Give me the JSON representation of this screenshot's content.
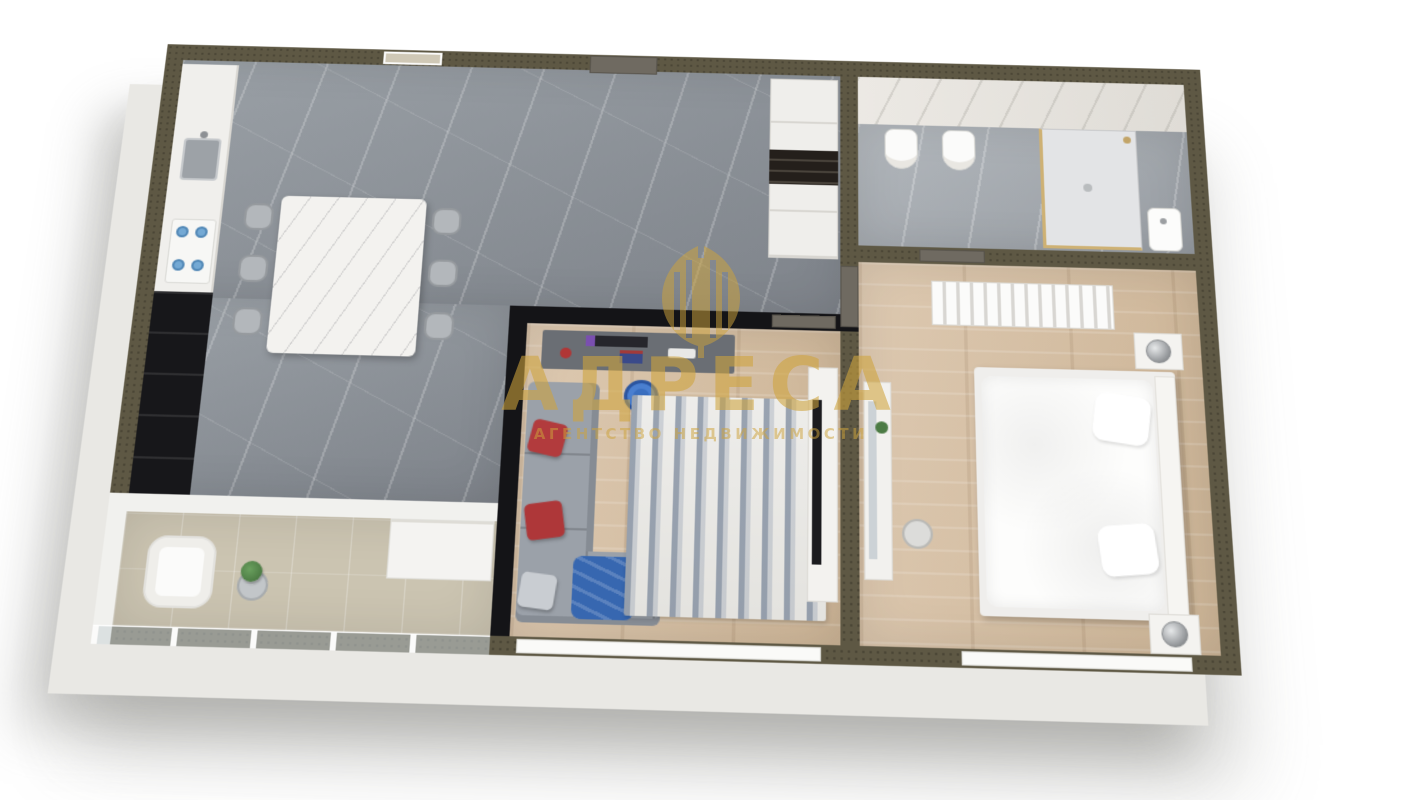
{
  "watermark": {
    "title": "АДРЕСА",
    "subtitle": "АГЕНТСТВО НЕДВИЖИМОСТИ",
    "logo": "building-emblem-icon",
    "gold_color": "#cea33c"
  },
  "palette": {
    "background": "#ffffff",
    "exterior_wall_top": "#5e5844",
    "interior_wall_black": "#141417",
    "exterior_wall_face": "#e9e8e4",
    "kitchen_marble_floor": "#8e9399",
    "wood_floor": "#d6c1a7",
    "bathroom_floor": "#a7acb2",
    "bathroom_marble_wall": "#e9e7e2",
    "balcony_floor": "#cbc4b1",
    "sofa_gray": "#9ba1a9",
    "pillow_red": "#b23b3d",
    "office_chair_blue": "#3a6fc0",
    "blanket_blue": "#3767b0",
    "dining_table_marble": "#f3f2ef",
    "door_gray_brown": "#6f6a61",
    "watermark_gold": "#cea33c"
  }
}
